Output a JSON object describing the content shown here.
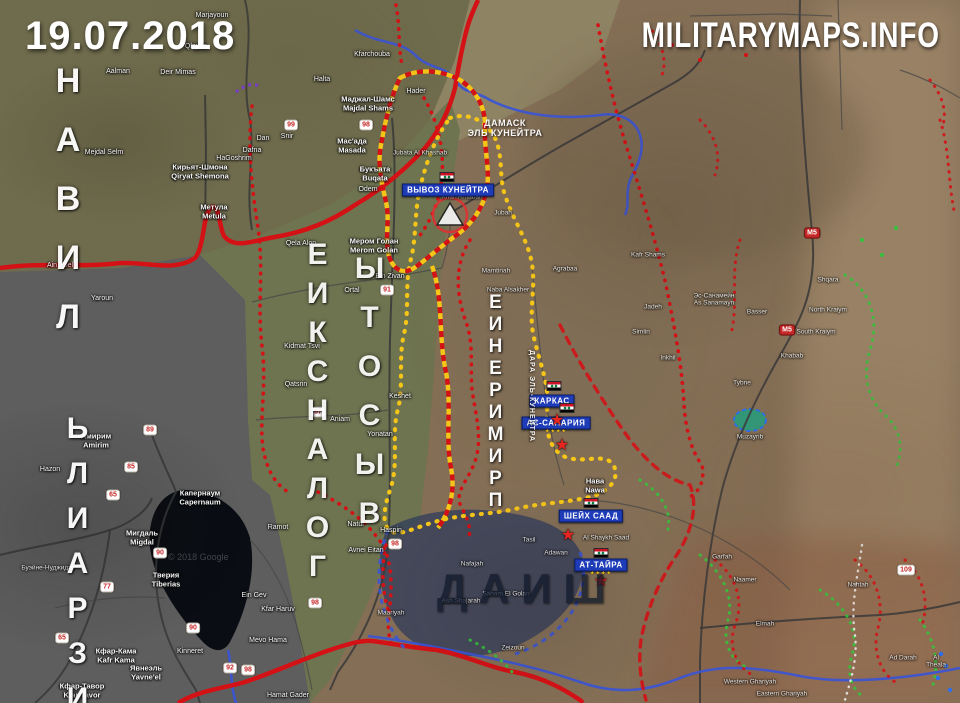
{
  "meta": {
    "date": "19.07.2018",
    "watermark": "MILITARYMAPS.INFO",
    "copyright": "© 2018 Google"
  },
  "theme": {
    "frontRed": "#d41216",
    "zoneYellow": "#f5c518",
    "riverBlue": "#3b55d6",
    "chainGreen": "#35c23c",
    "boxBlue": "#1e3bb8",
    "starRed": "#e8251f",
    "badgeRed": "#c62828",
    "flagRed": "#ce1126",
    "flagGreen": "#007a3d",
    "daeshFill": "#2e3a5c",
    "waterFill": "#0a0d13"
  },
  "region_labels": [
    {
      "text": "ЛИВАН",
      "dir": "v",
      "rev": true,
      "x": 48,
      "y": 62,
      "fs": 34,
      "ls": 21,
      "op": 0.95
    },
    {
      "text": "ИЗРАИЛЬ",
      "dir": "v",
      "rev": true,
      "x": 60,
      "y": 412,
      "fs": 30,
      "ls": 12,
      "op": 0.95
    },
    {
      "text": "ГОЛАНСКИЕ",
      "dir": "v",
      "rev": true,
      "x": 300,
      "y": 238,
      "fs": 30,
      "ls": 6,
      "op": 0.9
    },
    {
      "text": "ВЫСОТЫ",
      "dir": "v",
      "rev": true,
      "x": 352,
      "y": 252,
      "fs": 30,
      "ls": 16,
      "op": 0.9
    },
    {
      "text": "ПРИМИРЕНИЕ",
      "dir": "v",
      "rev": true,
      "x": 484,
      "y": 292,
      "fs": 19,
      "ls": 1,
      "op": 0.95
    },
    {
      "text": "ДАИШ",
      "dir": "h",
      "x": 437,
      "y": 565,
      "fs": 42,
      "ls": 12,
      "color": "#10192b",
      "op": 0.75
    },
    {
      "text": "ДАМАСК\nЭЛЬ КУНЕЙТРА",
      "dir": "h",
      "x": 505,
      "y": 118,
      "fs": 9,
      "ls": 0.5,
      "center": true,
      "op": 0.95
    },
    {
      "text": "ДАРА ЭЛЬ-КУНЕЙТРА",
      "dir": "vr",
      "x": 528,
      "y": 350,
      "fs": 7,
      "ls": 1,
      "op": 0.9
    }
  ],
  "event_boxes": [
    {
      "label": "ВЫВОЗ КУНЕЙТРА",
      "x": 448,
      "y": 190
    },
    {
      "label": "КАРКАС",
      "x": 552,
      "y": 401
    },
    {
      "label": "АС-САНАРИЯ",
      "x": 556,
      "y": 423
    },
    {
      "label": "ШЕЙХ СААД",
      "x": 591,
      "y": 516
    },
    {
      "label": "АТ-ТАЙРА",
      "x": 601,
      "y": 565
    }
  ],
  "markers": {
    "flags": [
      {
        "x": 447,
        "y": 177
      },
      {
        "x": 554,
        "y": 386
      },
      {
        "x": 567,
        "y": 408
      },
      {
        "x": 591,
        "y": 503
      },
      {
        "x": 601,
        "y": 553
      }
    ],
    "stars": [
      {
        "x": 557,
        "y": 421
      },
      {
        "x": 562,
        "y": 446
      },
      {
        "x": 568,
        "y": 536
      },
      {
        "x": 601,
        "y": 582
      }
    ],
    "ministars": [
      {
        "x": 556,
        "y": 432
      },
      {
        "x": 601,
        "y": 574
      }
    ]
  },
  "badges": [
    {
      "n": "90",
      "x": 160,
      "y": 553
    },
    {
      "n": "90",
      "x": 193,
      "y": 628
    },
    {
      "n": "65",
      "x": 113,
      "y": 495
    },
    {
      "n": "65",
      "x": 62,
      "y": 638
    },
    {
      "n": "85",
      "x": 131,
      "y": 467
    },
    {
      "n": "89",
      "x": 150,
      "y": 430
    },
    {
      "n": "77",
      "x": 107,
      "y": 587
    },
    {
      "n": "92",
      "x": 230,
      "y": 668
    },
    {
      "n": "98",
      "x": 248,
      "y": 670
    },
    {
      "n": "98",
      "x": 315,
      "y": 603
    },
    {
      "n": "98",
      "x": 366,
      "y": 125
    },
    {
      "n": "98",
      "x": 395,
      "y": 544
    },
    {
      "n": "99",
      "x": 291,
      "y": 125
    },
    {
      "n": "91",
      "x": 387,
      "y": 290
    },
    {
      "n": "87",
      "x": 318,
      "y": 412
    },
    {
      "n": "109",
      "x": 906,
      "y": 570
    },
    {
      "n": "M5",
      "x": 812,
      "y": 233,
      "m5": true
    },
    {
      "n": "M5",
      "x": 787,
      "y": 330,
      "m5": true
    }
  ],
  "towns": [
    {
      "n": "Marjayoun",
      "x": 212,
      "y": 16
    },
    {
      "n": "Qlayaa",
      "x": 196,
      "y": 47
    },
    {
      "n": "Deir Mimas",
      "x": 178,
      "y": 73
    },
    {
      "n": "Aalman",
      "x": 118,
      "y": 72
    },
    {
      "n": "Mejdal Selm",
      "x": 104,
      "y": 153
    },
    {
      "n": "Ain Ebel",
      "x": 60,
      "y": 266
    },
    {
      "n": "Yaroun",
      "x": 102,
      "y": 299
    },
    {
      "n": "Kfarchouba",
      "x": 372,
      "y": 55
    },
    {
      "n": "Halta",
      "x": 322,
      "y": 80
    },
    {
      "n": "Метула\nMetula",
      "x": 214,
      "y": 212,
      "s": 2
    },
    {
      "n": "Кирьят-Шмона\nQiryat Shemona",
      "x": 200,
      "y": 172,
      "s": 2
    },
    {
      "n": "Маджал-Шамс\nMajdal Shams",
      "x": 368,
      "y": 104,
      "s": 2
    },
    {
      "n": "Hader",
      "x": 416,
      "y": 92
    },
    {
      "n": "Мас'ада\nMasada",
      "x": 352,
      "y": 146,
      "s": 2
    },
    {
      "n": "Букъата\nBuqata",
      "x": 375,
      "y": 174,
      "s": 2
    },
    {
      "n": "Odem",
      "x": 368,
      "y": 190
    },
    {
      "n": "Dan",
      "x": 263,
      "y": 139
    },
    {
      "n": "Snir",
      "x": 287,
      "y": 137
    },
    {
      "n": "Dafna",
      "x": 252,
      "y": 151
    },
    {
      "n": "HaGoshrim",
      "x": 234,
      "y": 159
    },
    {
      "n": "Мером Голан\nMerom Golan",
      "x": 374,
      "y": 246,
      "s": 2
    },
    {
      "n": "Ein Zivan",
      "x": 390,
      "y": 277
    },
    {
      "n": "Ortal",
      "x": 352,
      "y": 291
    },
    {
      "n": "Qela Alon",
      "x": 301,
      "y": 244
    },
    {
      "n": "Kidmat Tsvi",
      "x": 302,
      "y": 347
    },
    {
      "n": "Qatsrin",
      "x": 296,
      "y": 385
    },
    {
      "n": "Aniam",
      "x": 340,
      "y": 420
    },
    {
      "n": "Keshet",
      "x": 400,
      "y": 397
    },
    {
      "n": "Yonatan",
      "x": 380,
      "y": 435
    },
    {
      "n": "Natur",
      "x": 356,
      "y": 525
    },
    {
      "n": "Haspin",
      "x": 391,
      "y": 531
    },
    {
      "n": "Avnei Eitan",
      "x": 366,
      "y": 551
    },
    {
      "n": "Амирим\nAmirim",
      "x": 96,
      "y": 441,
      "s": 2
    },
    {
      "n": "Hazon",
      "x": 50,
      "y": 470
    },
    {
      "n": "Мигдаль\nMigdal",
      "x": 142,
      "y": 538,
      "s": 2
    },
    {
      "n": "Капернаум\nCapernaum",
      "x": 200,
      "y": 498,
      "s": 2
    },
    {
      "n": "Тверия\nTiberias",
      "x": 166,
      "y": 580,
      "s": 2
    },
    {
      "n": "Кфар-Кама\nKafr Kama",
      "x": 116,
      "y": 656,
      "s": 2
    },
    {
      "n": "Кфар-Тавор\nKfar Tavor",
      "x": 82,
      "y": 691,
      "s": 2
    },
    {
      "n": "Явнеэль\nYavne'el",
      "x": 146,
      "y": 673,
      "s": 2
    },
    {
      "n": "Kinneret",
      "x": 190,
      "y": 652
    },
    {
      "n": "Буэйне-Нуджидат",
      "x": 48,
      "y": 568,
      "s": 3
    },
    {
      "n": "Ramot",
      "x": 278,
      "y": 528
    },
    {
      "n": "Ein Gev",
      "x": 254,
      "y": 596
    },
    {
      "n": "Kfar Haruv",
      "x": 278,
      "y": 610
    },
    {
      "n": "Mevo Hama",
      "x": 268,
      "y": 641
    },
    {
      "n": "Hamat Gader",
      "x": 288,
      "y": 696
    },
    {
      "n": "Jubata Al Khashab",
      "x": 420,
      "y": 153,
      "s": 3
    },
    {
      "n": "Khan Arnabah",
      "x": 462,
      "y": 197,
      "s": 3
    },
    {
      "n": "Jubah",
      "x": 503,
      "y": 213,
      "s": 3
    },
    {
      "n": "Mamtinah",
      "x": 496,
      "y": 271,
      "s": 3
    },
    {
      "n": "Naba Alsakher",
      "x": 508,
      "y": 290,
      "s": 3
    },
    {
      "n": "Agrabaa",
      "x": 565,
      "y": 269,
      "s": 3
    },
    {
      "n": "Нава\nNawa",
      "x": 595,
      "y": 486,
      "s": 2
    },
    {
      "n": "Al Shaykh Saad",
      "x": 606,
      "y": 538,
      "s": 3
    },
    {
      "n": "Adawan",
      "x": 556,
      "y": 553,
      "s": 3
    },
    {
      "n": "Tasil",
      "x": 529,
      "y": 540,
      "s": 3
    },
    {
      "n": "Nafajah",
      "x": 472,
      "y": 564,
      "s": 3
    },
    {
      "n": "Ash Shajarah",
      "x": 461,
      "y": 601,
      "s": 3
    },
    {
      "n": "Saham El Golan",
      "x": 506,
      "y": 594,
      "s": 3
    },
    {
      "n": "Zeizoun",
      "x": 513,
      "y": 648,
      "s": 3
    },
    {
      "n": "Maariyah",
      "x": 391,
      "y": 613,
      "s": 3
    },
    {
      "n": "Kafr Shams",
      "x": 648,
      "y": 255,
      "s": 3
    },
    {
      "n": "Jadeh",
      "x": 653,
      "y": 307,
      "s": 3
    },
    {
      "n": "Simlin",
      "x": 641,
      "y": 332,
      "s": 3
    },
    {
      "n": "Inkhil",
      "x": 668,
      "y": 358,
      "s": 3
    },
    {
      "n": "Эс-Санамейн\nAs Sanamayn",
      "x": 714,
      "y": 300,
      "s": 3
    },
    {
      "n": "Basser",
      "x": 757,
      "y": 312,
      "s": 3
    },
    {
      "n": "Khabab",
      "x": 792,
      "y": 356,
      "s": 3
    },
    {
      "n": "North Kraiym",
      "x": 828,
      "y": 310,
      "s": 3
    },
    {
      "n": "South Kraiym",
      "x": 816,
      "y": 332,
      "s": 3
    },
    {
      "n": "Shqara",
      "x": 828,
      "y": 280,
      "s": 3
    },
    {
      "n": "Tybne",
      "x": 742,
      "y": 383,
      "s": 3
    },
    {
      "n": "Muzayrib",
      "x": 750,
      "y": 437,
      "s": 3
    },
    {
      "n": "Garfah",
      "x": 722,
      "y": 557,
      "s": 3
    },
    {
      "n": "Naamer",
      "x": 745,
      "y": 580,
      "s": 3
    },
    {
      "n": "Elmah",
      "x": 765,
      "y": 624,
      "s": 3
    },
    {
      "n": "Nahtah",
      "x": 858,
      "y": 585,
      "s": 3
    },
    {
      "n": "Ad Darah",
      "x": 903,
      "y": 658,
      "s": 3
    },
    {
      "n": "Al Theala",
      "x": 936,
      "y": 662,
      "s": 3
    },
    {
      "n": "Western Ghariyah",
      "x": 750,
      "y": 682,
      "s": 3
    },
    {
      "n": "Eastern Ghariyah",
      "x": 782,
      "y": 694,
      "s": 3
    }
  ]
}
